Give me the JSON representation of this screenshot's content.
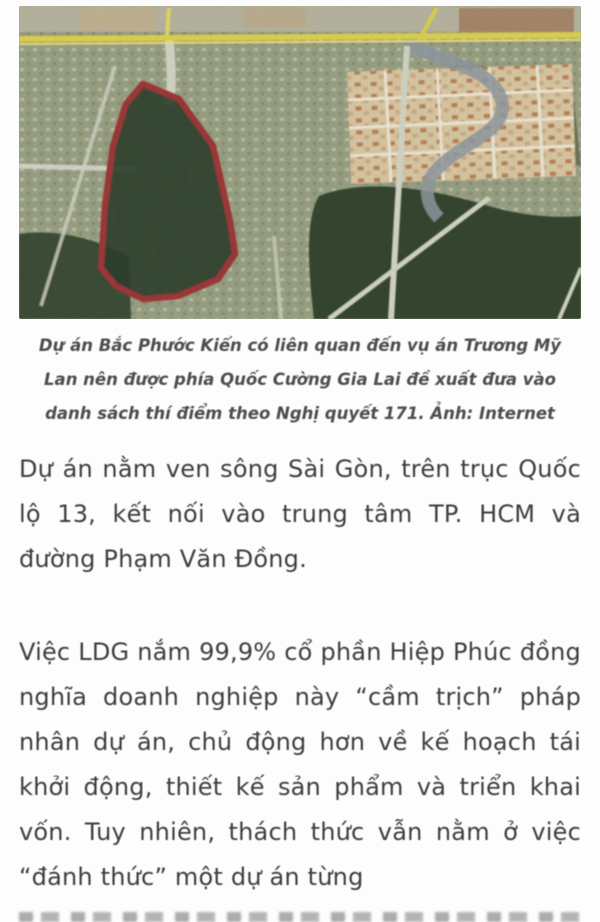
{
  "page": {
    "background": "#fdfdfd"
  },
  "figure": {
    "type": "satellite-map",
    "description": "satellite photo with project land plot outlined in red",
    "highlight_outline_color": "#9e3839",
    "plot_fill_color": "#2c3f2c",
    "highway_color": "#ded24e",
    "caption": "Dự án Bắc Phước Kiển có liên quan đến vụ án Trương Mỹ Lan nên được phía Quốc Cường Gia Lai đề xuất đưa vào danh sách thí điểm theo Nghị quyết 171. Ảnh: Internet"
  },
  "article": {
    "paragraphs": [
      "Dự án nằm ven sông Sài Gòn, trên trục Quốc lộ 13, kết nối vào trung tâm TP. HCM và đường Phạm Văn Đồng.",
      "Việc LDG nắm 99,9% cổ phần Hiệp Phúc đồng nghĩa doanh nghiệp này “cầm trịch” pháp nhân dự án, chủ động hơn về kế hoạch tái khởi động, thiết kế sản phẩm và triển khai vốn. Tuy nhiên, thách thức vẫn nằm ở việc “đánh thức” một dự án từng"
    ]
  }
}
